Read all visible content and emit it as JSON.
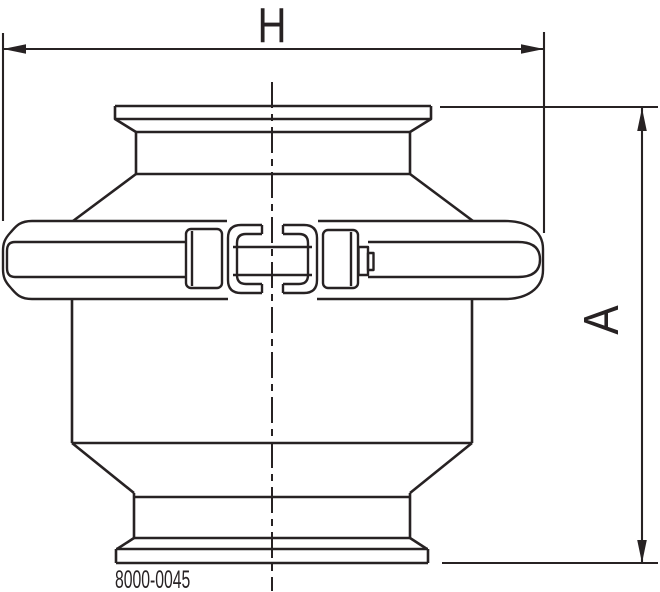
{
  "drawing": {
    "dimensions": {
      "width_label": "H",
      "height_label": "A"
    },
    "drawing_number": "8000-0045",
    "colors": {
      "line": "#272223",
      "background": "#ffffff"
    }
  }
}
